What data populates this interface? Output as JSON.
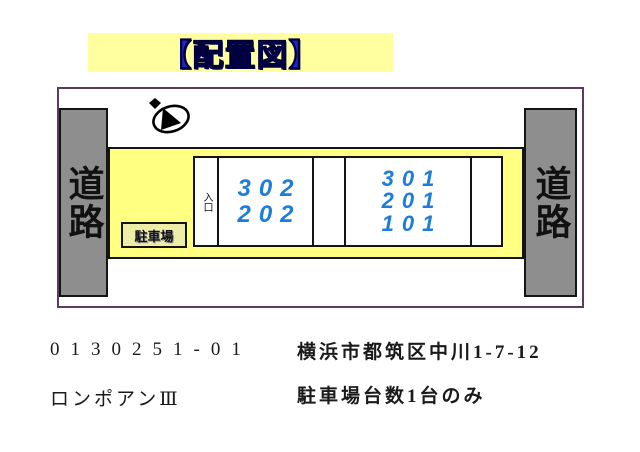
{
  "title": {
    "text": "【配置図】"
  },
  "diagram": {
    "road_left": "道路",
    "road_right": "道路",
    "compass_icon": "north-arrow",
    "entrance": "入口",
    "parking_label": "駐車場",
    "units_left": [
      "302",
      "202"
    ],
    "units_right": [
      "301",
      "201",
      "101"
    ]
  },
  "footer": {
    "property_code": "0130251-01",
    "building_name": "ロンポアンⅢ",
    "address": "横浜市都筑区中川1-7-12",
    "parking_note": "駐車場台数1台のみ"
  },
  "colors": {
    "banner_bg": "#ffffa0",
    "band_bg": "#ffff82",
    "road_gray": "#8e8e8e",
    "title_blue": "#2323cd",
    "unit_number_blue": "#1d7dd8",
    "frame_border_purple": "#5c3c5c",
    "line_black": "#141414"
  }
}
